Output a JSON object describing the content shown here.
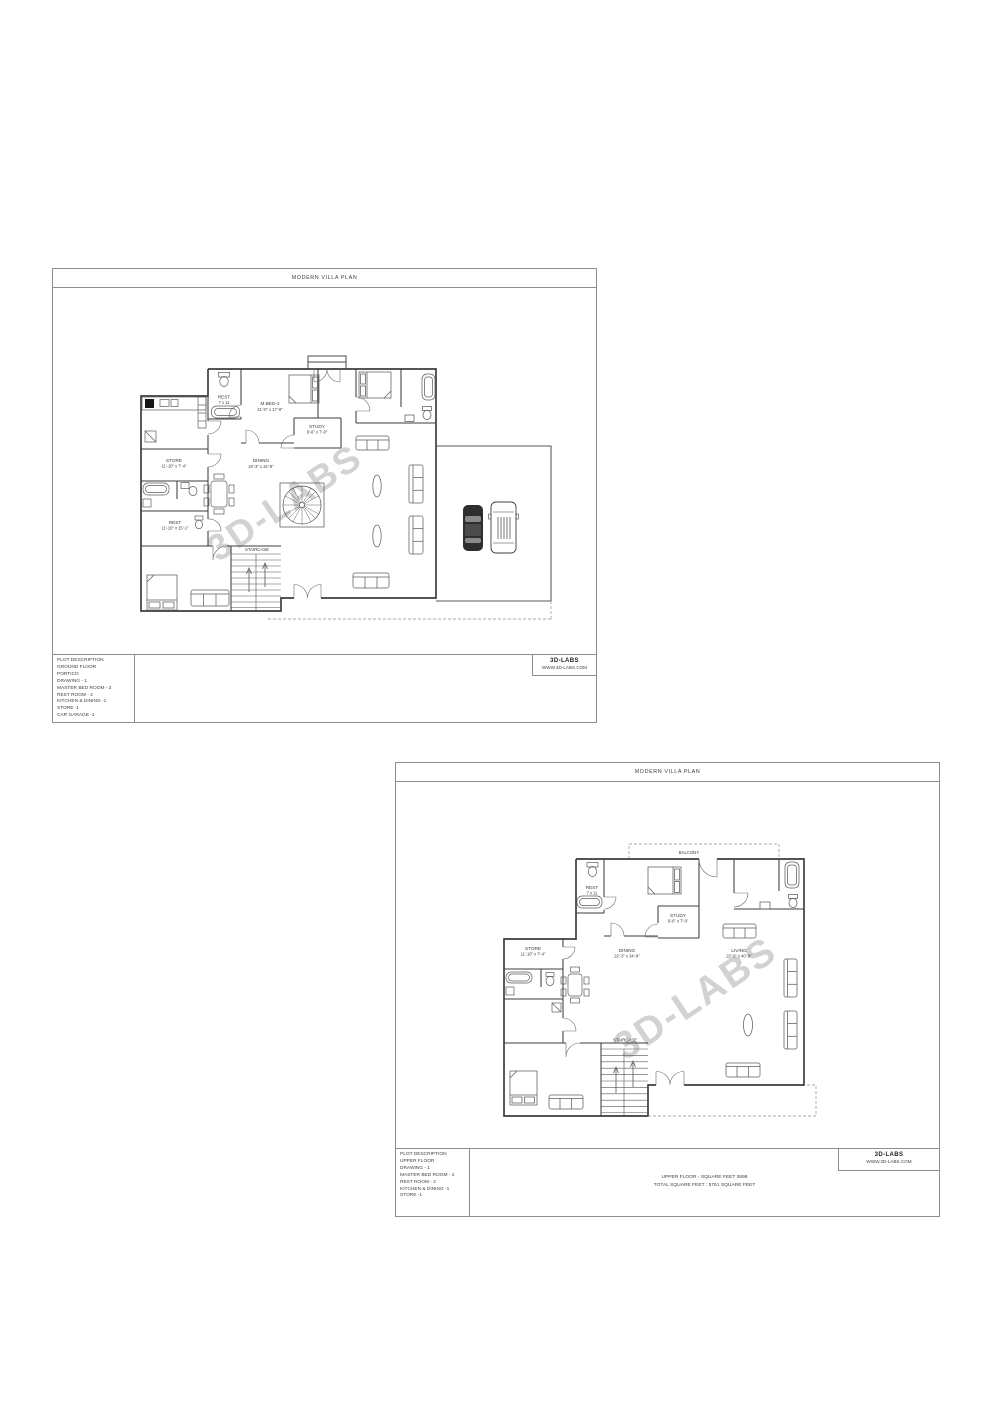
{
  "document": {
    "background": "#ffffff"
  },
  "sheet1": {
    "title": "MODERN VILLA PLAN",
    "watermark": "3D-LABS",
    "rooms": {
      "rest_top": {
        "name": "REST",
        "dims": "7 x 11"
      },
      "mbed2": {
        "name": "M.BED-2",
        "dims": "21'-0\" x 17'-9\""
      },
      "study": {
        "name": "STUDY",
        "dims": "9'-6\" x 7'-0\""
      },
      "store": {
        "name": "STORE",
        "dims": "11'-10\" x 7'-4\""
      },
      "dining": {
        "name": "DINING",
        "dims": "22'-3\" x 34'-9\""
      },
      "rest_mid": {
        "name": "REST",
        "dims": "11'-10\" x 15'-1\""
      },
      "staircase": {
        "name": "STAIRCASE"
      }
    },
    "title_block": {
      "plot_description": [
        "PLOT DESCRIPTION",
        "GROUND FLOOR",
        "PORTICO",
        "DRAWING  - 1",
        "MASTER BED ROOM - 2",
        "REST ROOM - 2",
        "KITCHEN & DINING -1",
        "STORE -1",
        "CAR GARAGE -1"
      ],
      "logo_name": "3D-LABS",
      "logo_site": "WWW.3D-LABS.COM"
    }
  },
  "sheet2": {
    "title": "MODERN VILLA PLAN",
    "watermark": "3D-LABS",
    "rooms": {
      "balcony": {
        "name": "BALCONY"
      },
      "rest_top": {
        "name": "REST",
        "dims": "7 x 11"
      },
      "study": {
        "name": "STUDY",
        "dims": "9'-6\" x 7'-0\""
      },
      "store": {
        "name": "STORE",
        "dims": "11'-10\" x 7'-4\""
      },
      "dining": {
        "name": "DINING",
        "dims": "22'-3\" x 34'-9\""
      },
      "living": {
        "name": "LIVING",
        "dims": "22'-0\" x 40'-9\""
      },
      "staircase": {
        "name": "STAIRCASE"
      }
    },
    "title_block": {
      "plot_description": [
        "PLOT DESCRIPTION",
        "UPPER FLOOR",
        "DRAWING  - 1",
        "MASTER BED ROOM - 2",
        "REST ROOM - 2",
        "KITCHEN & DINING -1",
        "STORE -1"
      ],
      "area_notes": [
        "UPPER FLOOR  - SQUARE FEET 3699",
        "TOTAL SQUARE FEET : 5761 SQUARE FEET"
      ],
      "logo_name": "3D-LABS",
      "logo_site": "WWW.3D-LABS.COM"
    }
  }
}
